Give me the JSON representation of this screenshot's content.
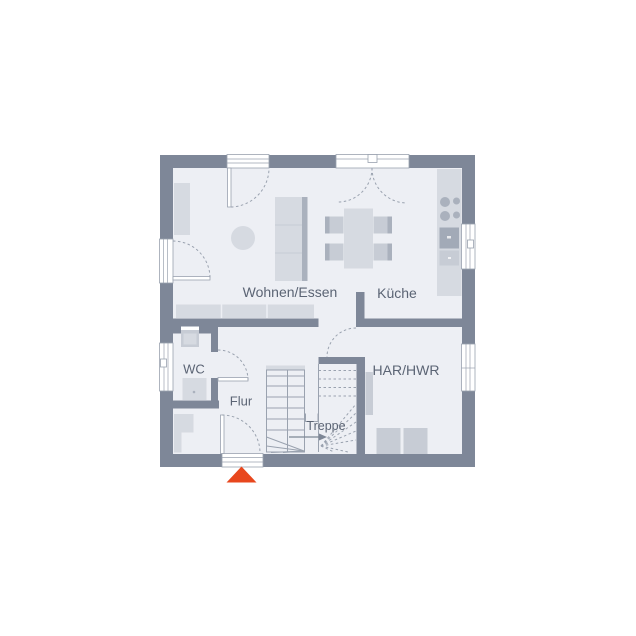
{
  "rooms": {
    "wohnen_essen": "Wohnen/Essen",
    "kueche": "Küche",
    "wc": "WC",
    "flur": "Flur",
    "treppe": "Treppe",
    "har_hwr": "HAR/HWR"
  },
  "markers": {
    "entrance": "triangle-arrow-up"
  },
  "colors": {
    "background": "#ffffff",
    "wall": "#7e8798",
    "floor": "#edeff4",
    "furniture_light": "#d6dae1",
    "furniture_mid": "#c7ccd5",
    "furniture_dark": "#aab1bd",
    "line": "#9aa2af",
    "label_text": "#5b6474",
    "entrance_marker": "#e8471d"
  }
}
